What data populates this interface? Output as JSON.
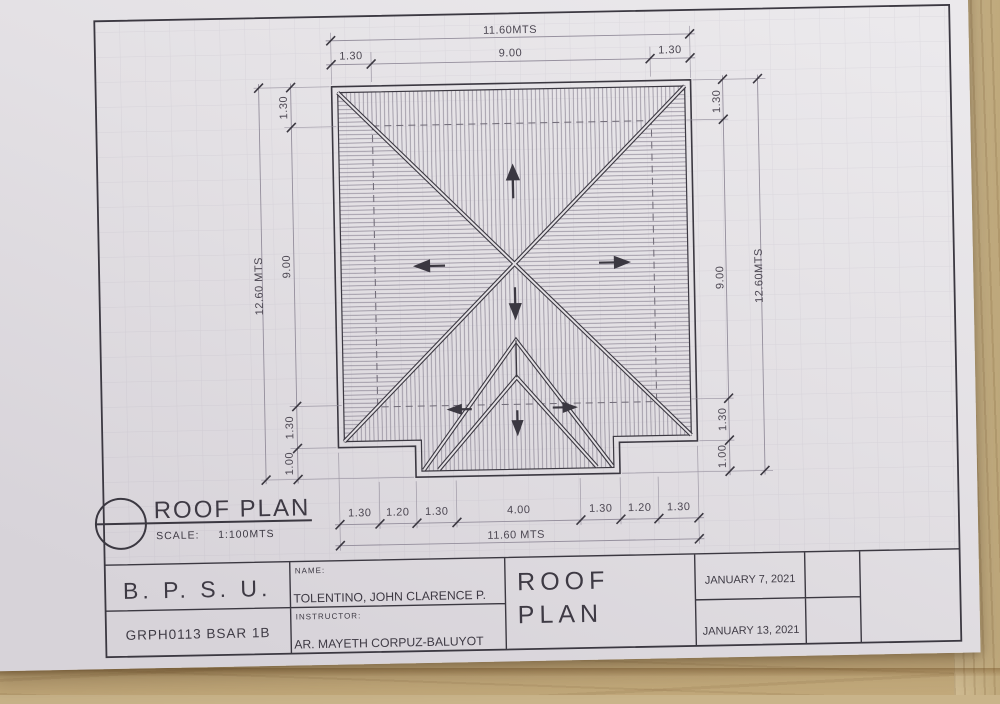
{
  "plan_label": {
    "title": "ROOF PLAN",
    "scale_label": "SCALE:",
    "scale_value": "1:100MTS"
  },
  "dimensions": {
    "top": {
      "overall": "11.60MTS",
      "segments": [
        "1.30",
        "9.00",
        "1.30"
      ]
    },
    "bottom": {
      "overall": "11.60 MTS",
      "segments": [
        "1.30",
        "1.20",
        "1.30",
        "4.00",
        "1.30",
        "1.20",
        "1.30"
      ]
    },
    "left": {
      "overall": "12.60 MTS",
      "segments": [
        "1.30",
        "9.00",
        "1.30",
        "1.00"
      ]
    },
    "right": {
      "overall": "12.60MTS",
      "segments": [
        "1.30",
        "9.00",
        "1.30",
        "1.00"
      ]
    }
  },
  "title_block": {
    "institution": "B. P. S. U.",
    "course_section": "GRPH0113 BSAR 1B",
    "name_label": "NAME:",
    "name": "TOLENTINO, JOHN CLARENCE P.",
    "instructor_label": "INSTRUCTOR:",
    "instructor": "AR. MAYETH CORPUZ-BALUYOT",
    "sheet_title_line1": "ROOF",
    "sheet_title_line2": "PLAN",
    "date1": "JANUARY 7, 2021",
    "date2": "JANUARY 13, 2021"
  },
  "colors": {
    "ink": "#3b3841",
    "pencil": "#56515c",
    "paper": "#e2dfe3",
    "wood": "#cdb88e"
  }
}
